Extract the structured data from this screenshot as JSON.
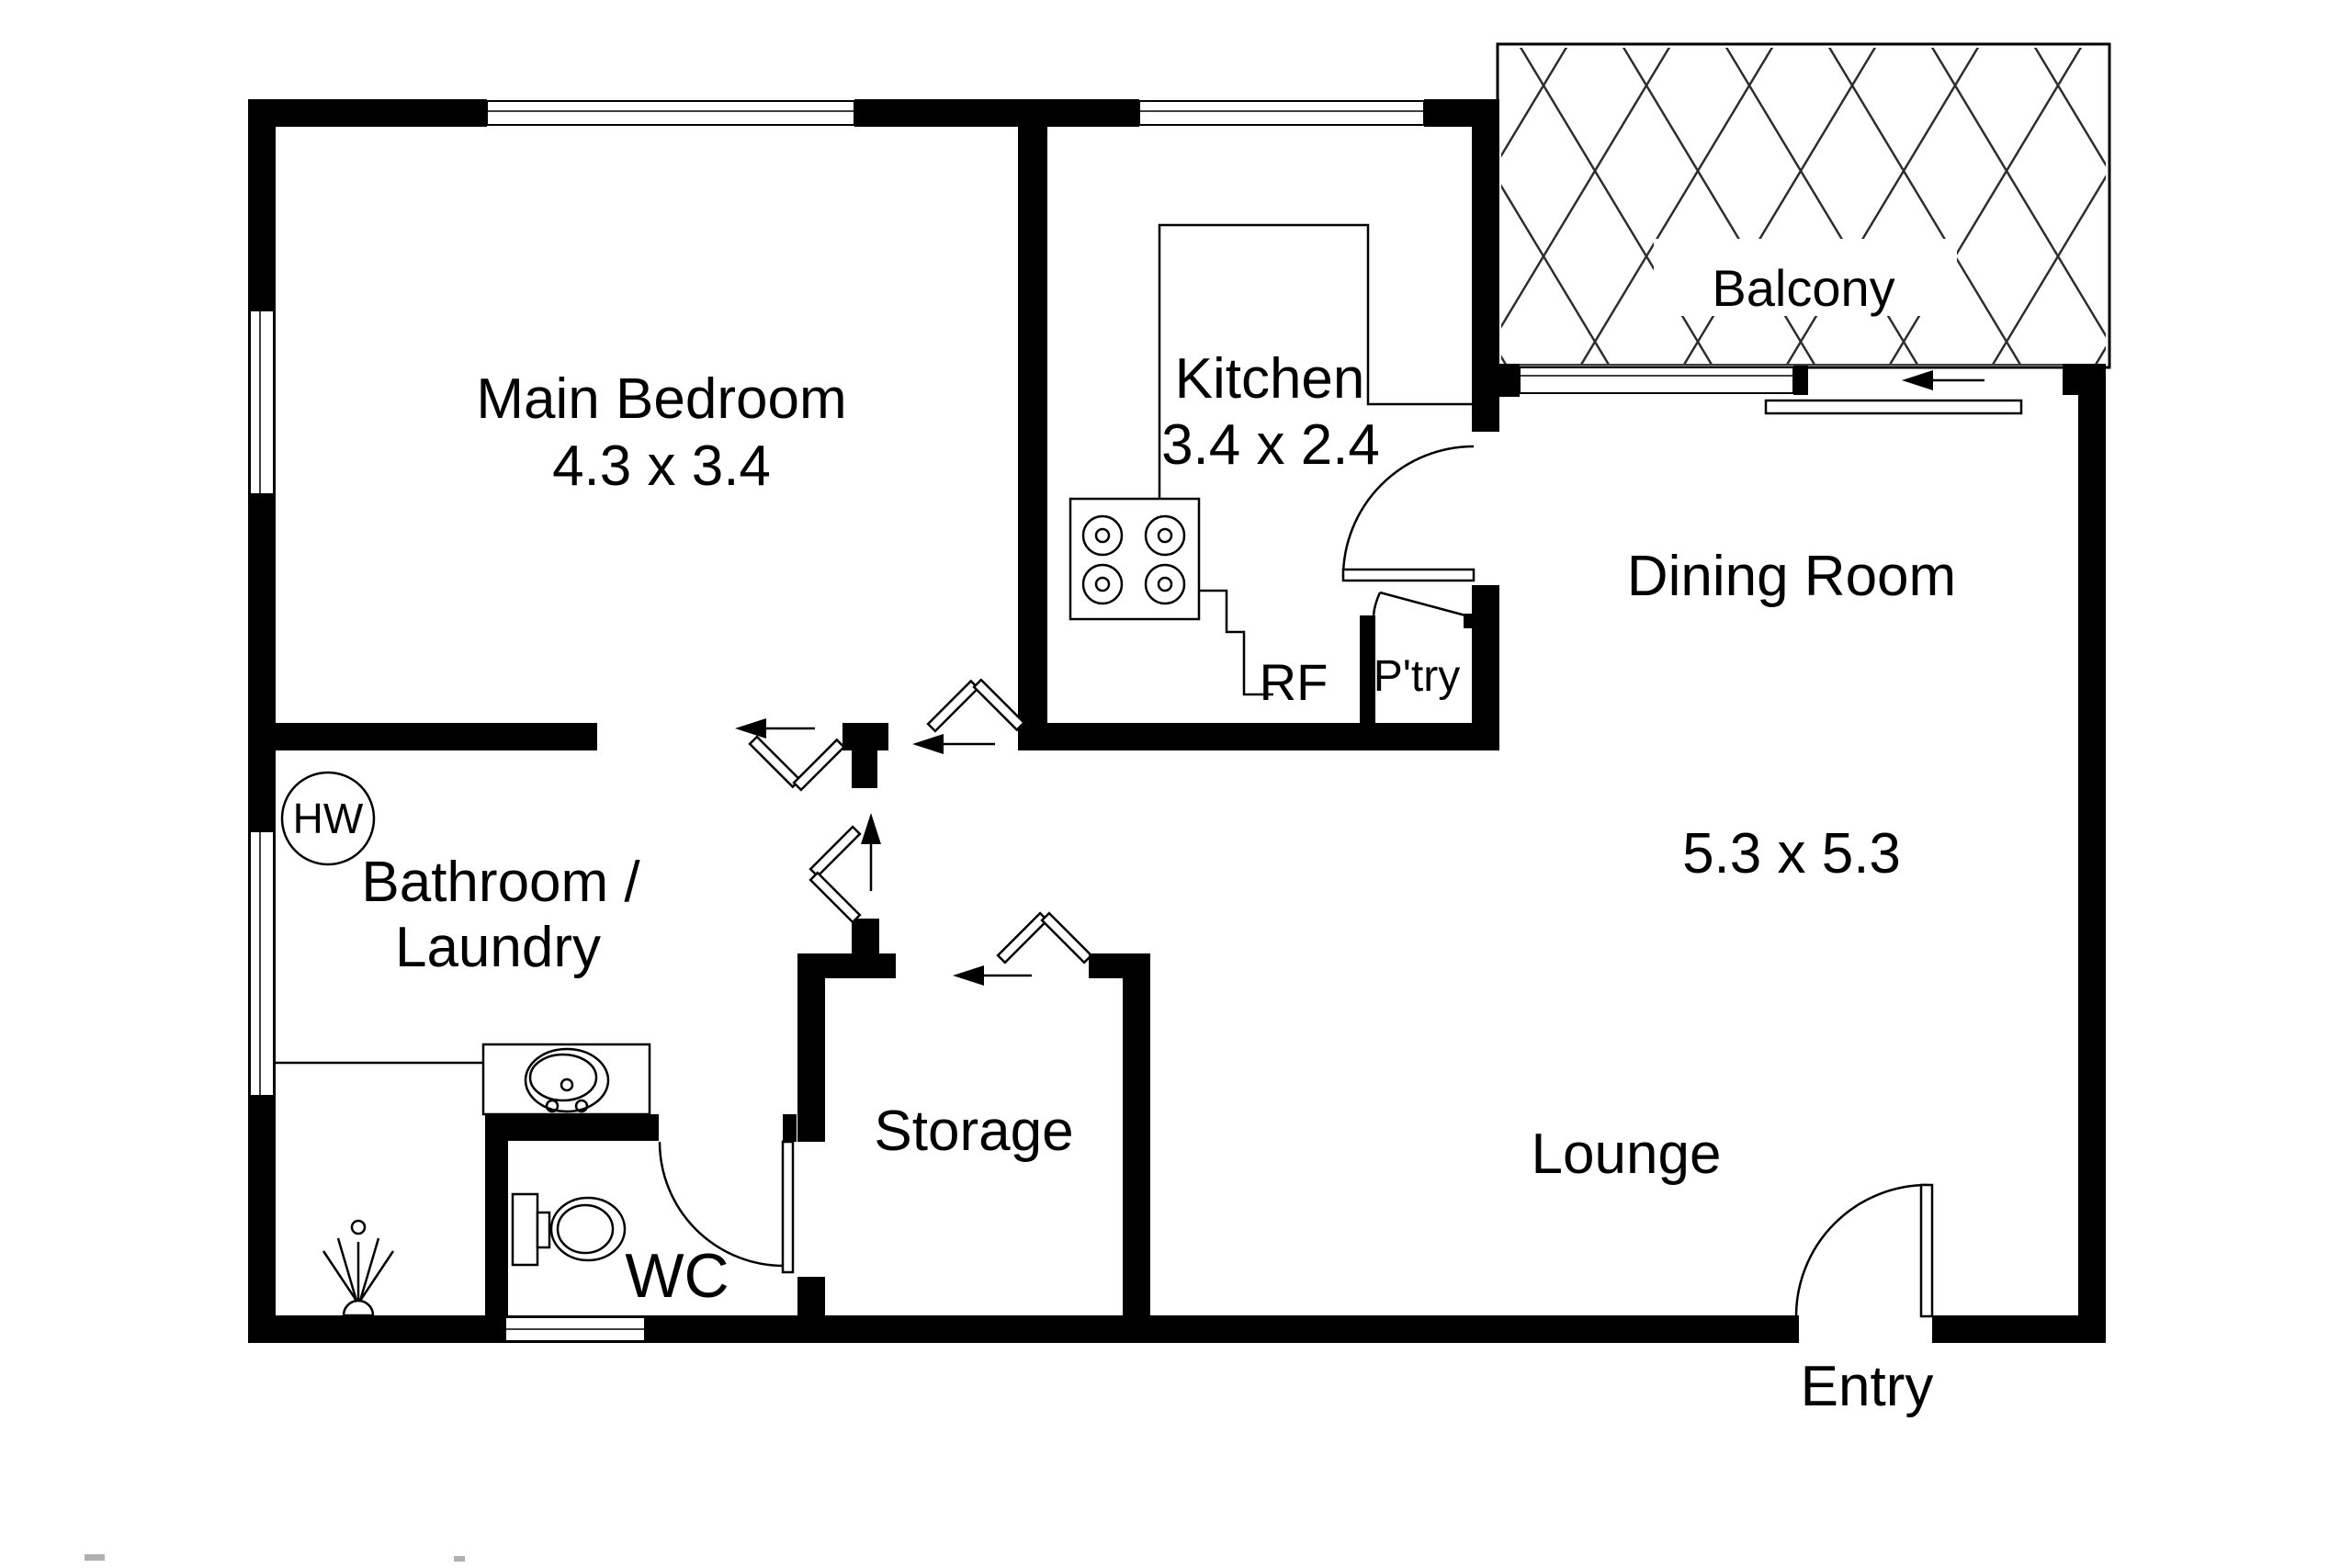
{
  "title": "Apartment floor plan",
  "colors": {
    "wall": "#000000",
    "line": "#000000",
    "bg": "#ffffff"
  },
  "labels": {
    "main_bedroom": "Main Bedroom",
    "main_bedroom_dim": "4.3 x 3.4",
    "kitchen": "Kitchen",
    "kitchen_dim": "3.4 x 2.4",
    "balcony": "Balcony",
    "dining": "Dining Room",
    "dining_dim": "5.3 x 5.3",
    "lounge": "Lounge",
    "bathroom_line1": "Bathroom /",
    "bathroom_line2": "Laundry",
    "storage": "Storage",
    "wc": "WC",
    "entry": "Entry",
    "pantry": "P'try",
    "fridge": "RF",
    "hot_water": "HW"
  },
  "rooms": [
    {
      "name": "Main Bedroom",
      "dimensions": "4.3 x 3.4"
    },
    {
      "name": "Kitchen",
      "dimensions": "3.4 x 2.4"
    },
    {
      "name": "Balcony",
      "dimensions": ""
    },
    {
      "name": "Dining Room",
      "dimensions": "5.3 x 5.3"
    },
    {
      "name": "Lounge",
      "dimensions": ""
    },
    {
      "name": "Bathroom / Laundry",
      "dimensions": ""
    },
    {
      "name": "Storage",
      "dimensions": ""
    },
    {
      "name": "WC",
      "dimensions": ""
    },
    {
      "name": "Entry",
      "dimensions": ""
    },
    {
      "name": "P'try",
      "dimensions": ""
    },
    {
      "name": "RF",
      "dimensions": ""
    }
  ],
  "fixtures": [
    "stove-icon",
    "kitchen-counter",
    "vanity-sink-icon",
    "toilet-icon",
    "shower-icon",
    "hot-water-icon",
    "balcony-lattice",
    "sliding-door",
    "hinged-door",
    "bifold-door",
    "window",
    "entry-arrow"
  ]
}
